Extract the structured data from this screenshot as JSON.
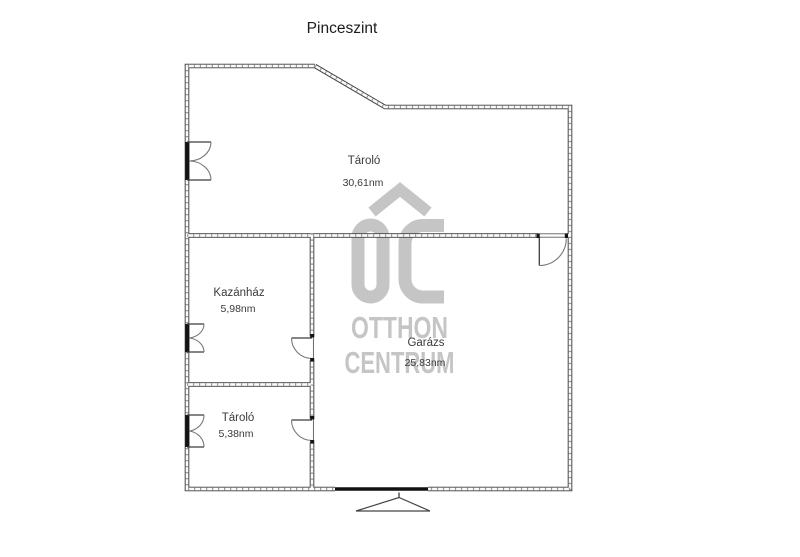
{
  "page": {
    "title": "Pinceszint"
  },
  "watermark": {
    "brand_initials": "OC",
    "line1": "OTTHON",
    "line2": "CENTRUM",
    "color": "#c5c5c5"
  },
  "floor_plan": {
    "level_name": "Pinceszint",
    "rooms": [
      {
        "name": "Tároló",
        "area": "30,61nm"
      },
      {
        "name": "Kazánház",
        "area": "5,98nm"
      },
      {
        "name": "Garázs",
        "area": "25,83nm"
      },
      {
        "name": "Tároló",
        "area": "5,38nm"
      }
    ]
  },
  "colors": {
    "wall": "#3f3f3f",
    "text": "#3a3a3a",
    "watermark": "#c5c5c5",
    "background": "#ffffff"
  }
}
